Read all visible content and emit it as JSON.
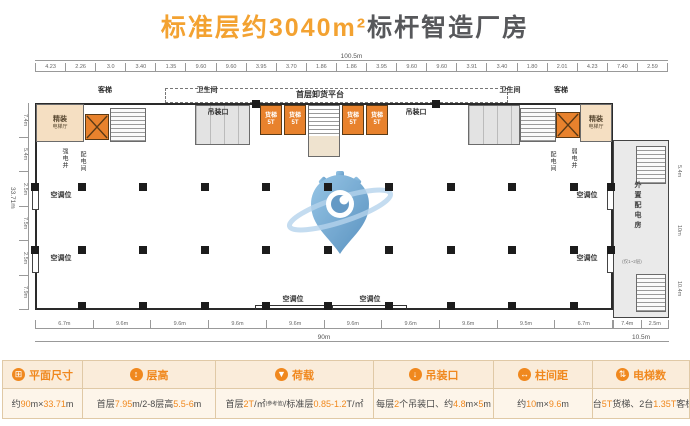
{
  "title": {
    "highlight": "标准层约3040m²",
    "rest": "标杆智造厂房"
  },
  "plan": {
    "platform_label": "首层卸货平台",
    "hoist_label": "吊装口",
    "passenger_elevator": "客梯",
    "toilet": "卫生间",
    "lobby_line1": "精装",
    "lobby_line2": "电梯厅",
    "freight_line1": "货梯",
    "freight_line2": "5T",
    "strong_shaft": "强电井",
    "dist_room": "配电间",
    "weak_shaft": "弱电井",
    "ac_label": "空调位",
    "annex_label": "外置配电房",
    "annex_sub": "(仅1~2层)"
  },
  "dims": {
    "top_total": "100.5m",
    "top": [
      "4.23",
      "2.26",
      "3.0",
      "3.40",
      "1.35",
      "9.60",
      "9.60",
      "3.95",
      "3.70",
      "1.86",
      "1.86",
      "3.95",
      "9.60",
      "9.60",
      "3.91",
      "3.40",
      "1.80",
      "2.01",
      "4.23",
      "7.40",
      "2.59"
    ],
    "left_total": "33.71m",
    "left": [
      "7.4m",
      "5.4m",
      "2.5m",
      "7.5m",
      "2.5m",
      "7.9m"
    ],
    "right": [
      "5.4m",
      "10m",
      "10.4m"
    ],
    "bottom_main": [
      "6.7m",
      "9.6m",
      "9.6m",
      "9.6m",
      "9.6m",
      "9.6m",
      "9.6m",
      "9.6m",
      "9.5m",
      "6.7m"
    ],
    "bottom_main_total": "90m",
    "bottom_annex": [
      "7.4m",
      "2.5m"
    ],
    "bottom_annex_total": "10.5m"
  },
  "infobar": {
    "items": [
      {
        "icon": "ruler-icon",
        "glyph": "⊞",
        "label": "平面尺寸",
        "value": [
          {
            "t": "约"
          },
          {
            "t": "90",
            "hl": 1
          },
          {
            "t": "m×"
          },
          {
            "t": "33.71",
            "hl": 1
          },
          {
            "t": "m"
          }
        ]
      },
      {
        "icon": "height-icon",
        "glyph": "↕",
        "label": "层高",
        "value": [
          {
            "t": "首层"
          },
          {
            "t": "7.95",
            "hl": 1
          },
          {
            "t": "m/2-8层高"
          },
          {
            "t": "5.5-6",
            "hl": 1
          },
          {
            "t": "m"
          }
        ]
      },
      {
        "icon": "load-icon",
        "glyph": "▼",
        "label": "荷载",
        "value": [
          {
            "t": "首层"
          },
          {
            "t": "2T",
            "hl": 1
          },
          {
            "t": "/㎡"
          },
          {
            "t": "(参考值)",
            "sm": 1
          },
          {
            "t": "/标准层"
          },
          {
            "t": "0.85-1.2",
            "hl": 1
          },
          {
            "t": "T/㎡"
          }
        ]
      },
      {
        "icon": "hoist-icon",
        "glyph": "↓",
        "label": "吊装口",
        "value": [
          {
            "t": "每层"
          },
          {
            "t": "2",
            "hl": 1
          },
          {
            "t": "个吊装口、约"
          },
          {
            "t": "4.8",
            "hl": 1
          },
          {
            "t": "m×"
          },
          {
            "t": "5",
            "hl": 1
          },
          {
            "t": "m"
          }
        ]
      },
      {
        "icon": "spacing-icon",
        "glyph": "↔",
        "label": "柱间距",
        "value": [
          {
            "t": "约"
          },
          {
            "t": "10",
            "hl": 1
          },
          {
            "t": "m×"
          },
          {
            "t": "9.6",
            "hl": 1
          },
          {
            "t": "m"
          }
        ]
      },
      {
        "icon": "elevator-icon",
        "glyph": "⇅",
        "label": "电梯数",
        "value": [
          {
            "t": "4台"
          },
          {
            "t": "5T",
            "hl": 1
          },
          {
            "t": "货梯、2台"
          },
          {
            "t": "1.35T",
            "hl": 1
          },
          {
            "t": "客梯"
          }
        ]
      }
    ]
  },
  "colors": {
    "accent": "#F0881E",
    "title_orange": "#F3A231",
    "title_dark": "#57585B",
    "elevator_orange": "#E8822D",
    "logo_blue": "#5B9BD5"
  }
}
